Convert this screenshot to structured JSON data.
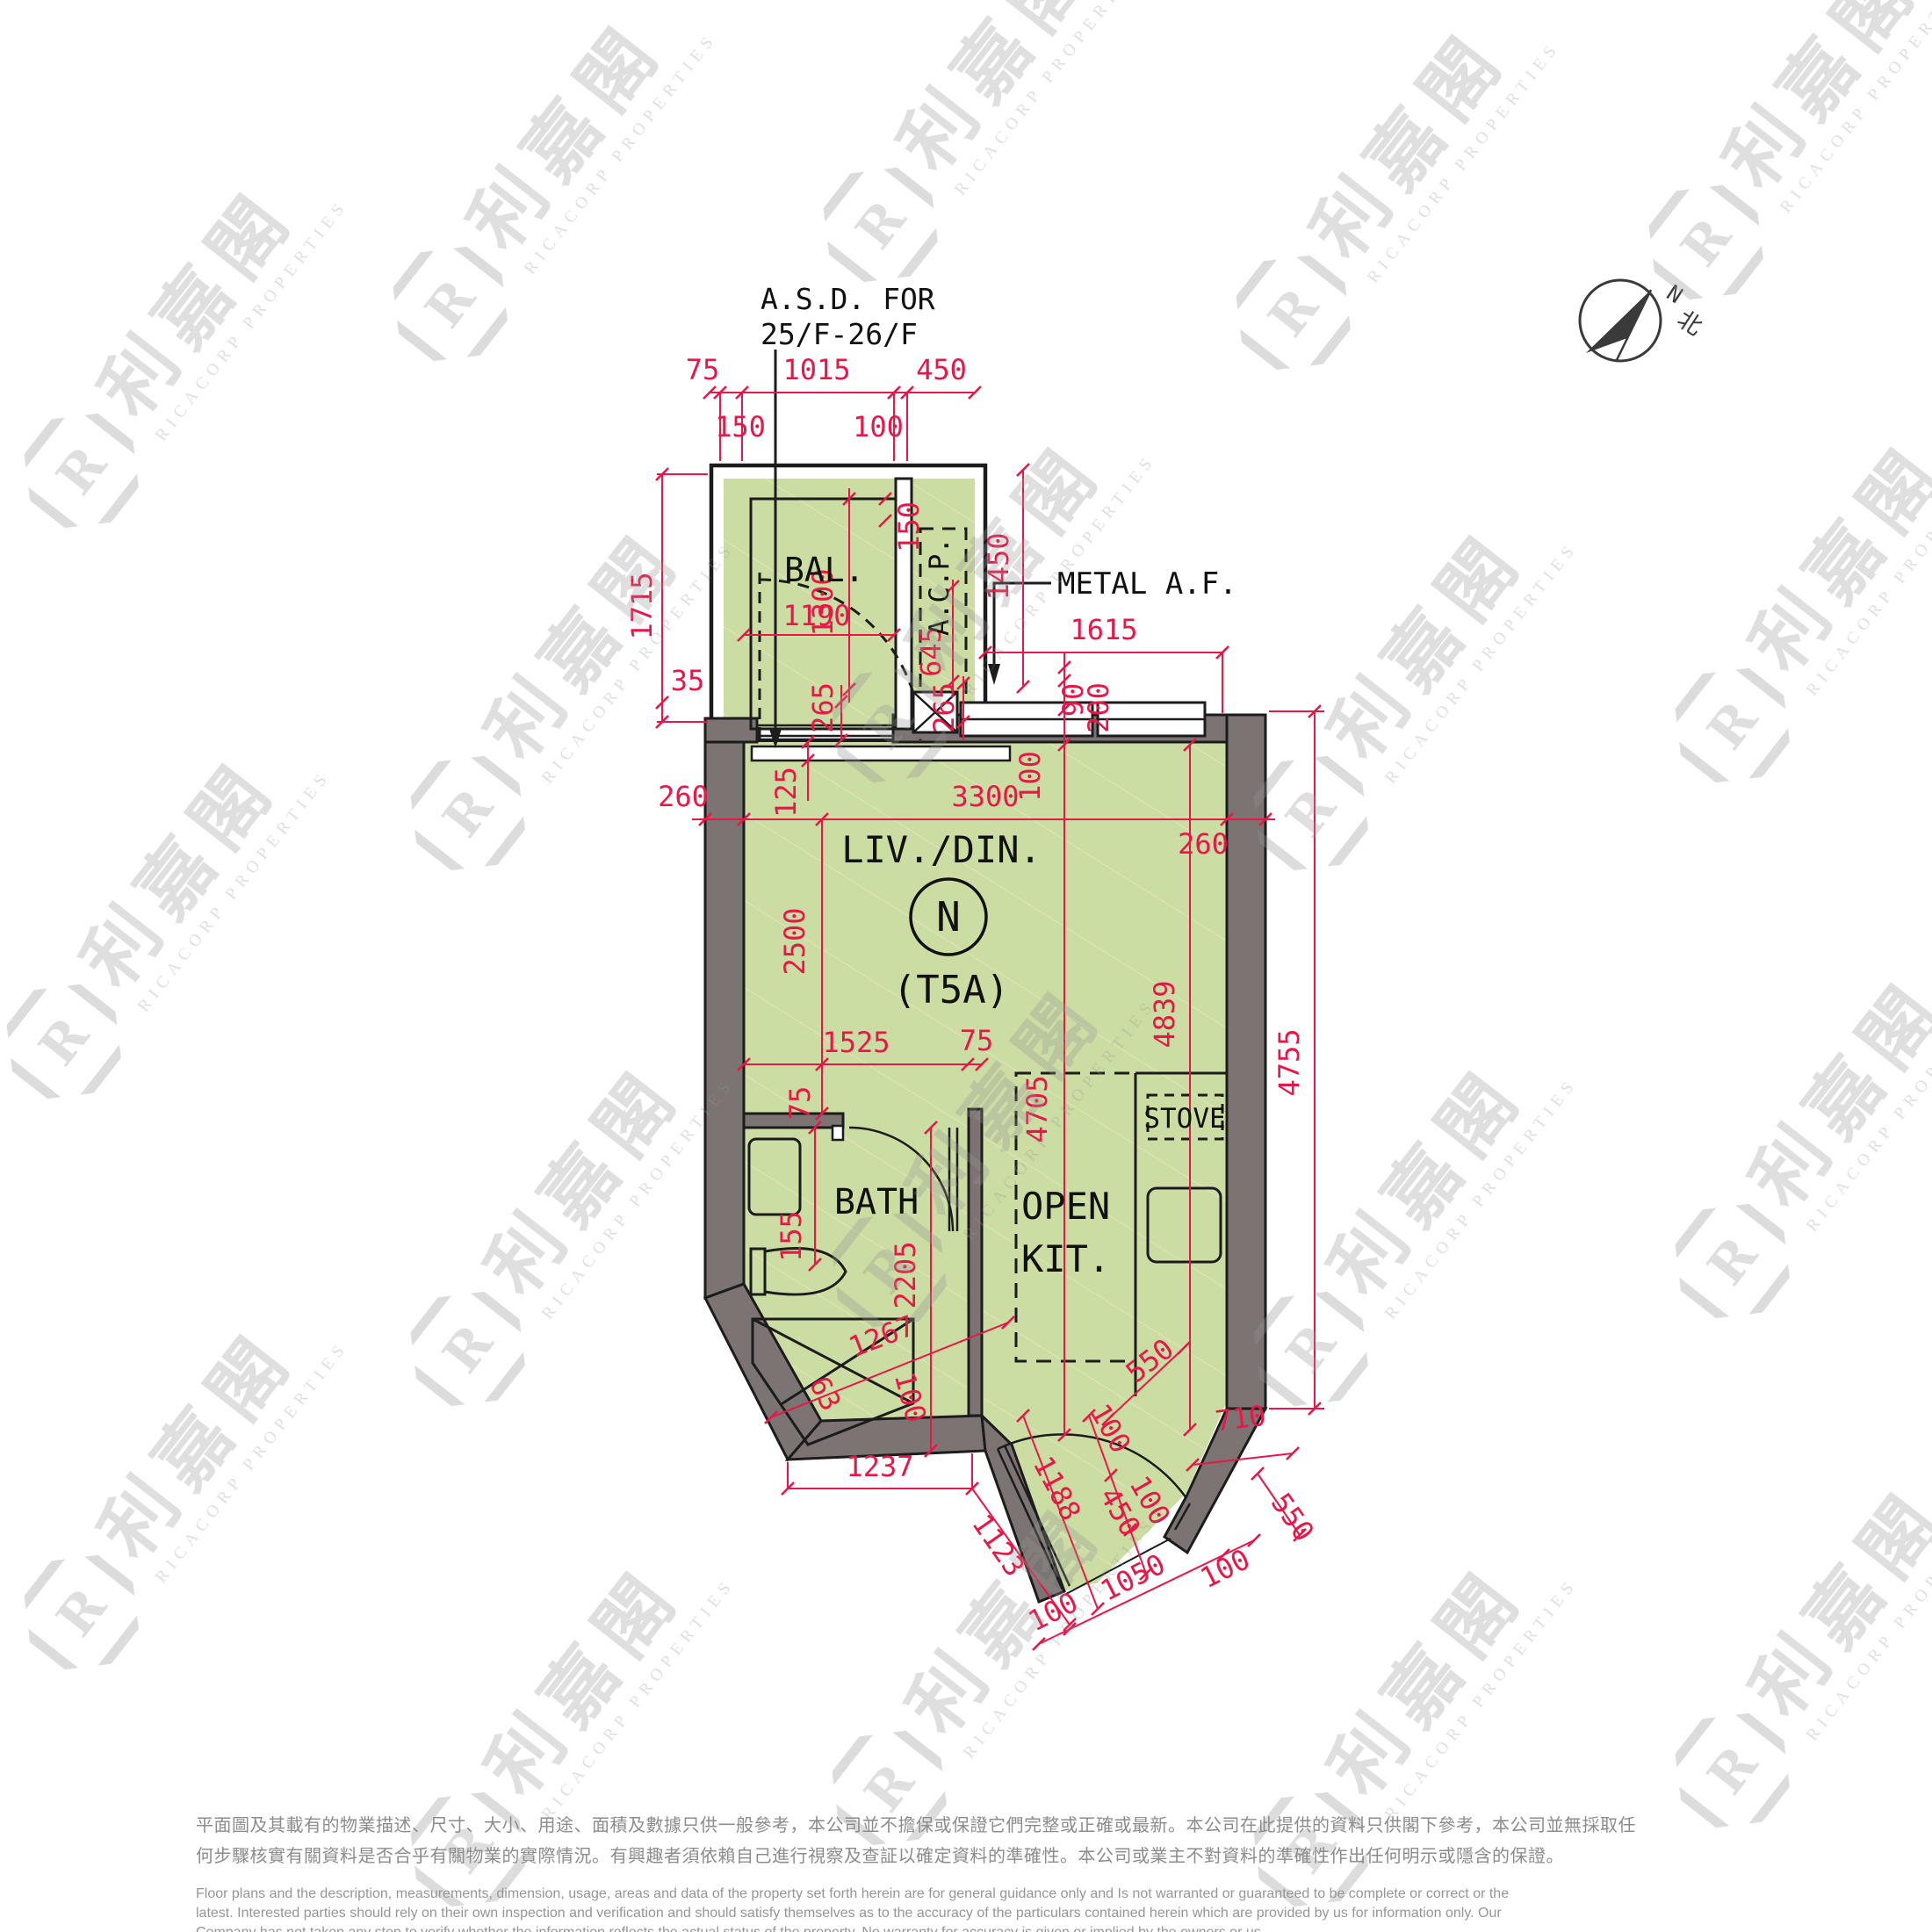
{
  "colors": {
    "floor_green": "#cbdda2",
    "hatch_line": "#dbe7bb",
    "wall_gray": "#7b7472",
    "dim_red": "#e81748",
    "line_black": "#1c1c1c",
    "watermark_gray": "#969696",
    "disclaimer_gray": "#8c8c8c"
  },
  "compass": {
    "n": "N",
    "north_cjk": "北"
  },
  "labels": {
    "asd1": "A.S.D. FOR",
    "asd2": "25/F-26/F",
    "metal_af": "METAL A.F.",
    "bal": "BAL.",
    "acp": "A.C.P.",
    "livdin": "LIV./DIN.",
    "unit_letter": "N",
    "unit_type": "(T5A)",
    "bath": "BATH",
    "open": "OPEN",
    "kit": "KIT.",
    "stove": "STOVE"
  },
  "dims": [
    {
      "v": "75"
    },
    {
      "v": "1015"
    },
    {
      "v": "450"
    },
    {
      "v": "150"
    },
    {
      "v": "100"
    },
    {
      "v": "1715"
    },
    {
      "v": "35"
    },
    {
      "v": "1300"
    },
    {
      "v": "150"
    },
    {
      "v": "1190"
    },
    {
      "v": "645"
    },
    {
      "v": "1450"
    },
    {
      "v": "1615"
    },
    {
      "v": "90"
    },
    {
      "v": "200"
    },
    {
      "v": "265"
    },
    {
      "v": "265"
    },
    {
      "v": "125"
    },
    {
      "v": "260"
    },
    {
      "v": "3300"
    },
    {
      "v": "260"
    },
    {
      "v": "100"
    },
    {
      "v": "2500"
    },
    {
      "v": "4839"
    },
    {
      "v": "4755"
    },
    {
      "v": "4705"
    },
    {
      "v": "1525"
    },
    {
      "v": "75"
    },
    {
      "v": "75"
    },
    {
      "v": "155"
    },
    {
      "v": "2205"
    },
    {
      "v": "1267"
    },
    {
      "v": "63"
    },
    {
      "v": "100"
    },
    {
      "v": "550"
    },
    {
      "v": "1237"
    },
    {
      "v": "1123"
    },
    {
      "v": "1188"
    },
    {
      "v": "100"
    },
    {
      "v": "450"
    },
    {
      "v": "100"
    },
    {
      "v": "710"
    },
    {
      "v": "550"
    },
    {
      "v": "100"
    },
    {
      "v": "1050"
    },
    {
      "v": "100"
    }
  ],
  "watermark": {
    "cjk": "利嘉閣",
    "en": "RICACORP PROPERTIES",
    "logo_letter": "R"
  },
  "disclaimer": {
    "zh1": "平面圖及其載有的物業描述、尺寸、大小、用途、面積及數據只供一般參考，本公司並不擔保或保證它們完整或正確或最新。本公司在此提供的資料只供閣下參考，本公司並無採取任",
    "zh2": "何步驟核實有關資料是否合乎有關物業的實際情況。有興趣者須依賴自己進行視察及查証以確定資料的準確性。本公司或業主不對資料的準確性作出任何明示或隱含的保證。",
    "en1": "Floor plans and the description, measurements, dimension, usage, areas and data of the property set forth herein are for general guidance only and Is not warranted or guaranteed to be complete or correct or the",
    "en2": "latest. Interested parties should rely on their own inspection and verification and should satisfy themselves as to the accuracy of the particulars contained herein which are provided by us for information only.  Our",
    "en3": "Company has not taken any step to verify whether the information reflects the actual status of the property.  No warranty for accuracy is given or implied by the owners or us."
  }
}
